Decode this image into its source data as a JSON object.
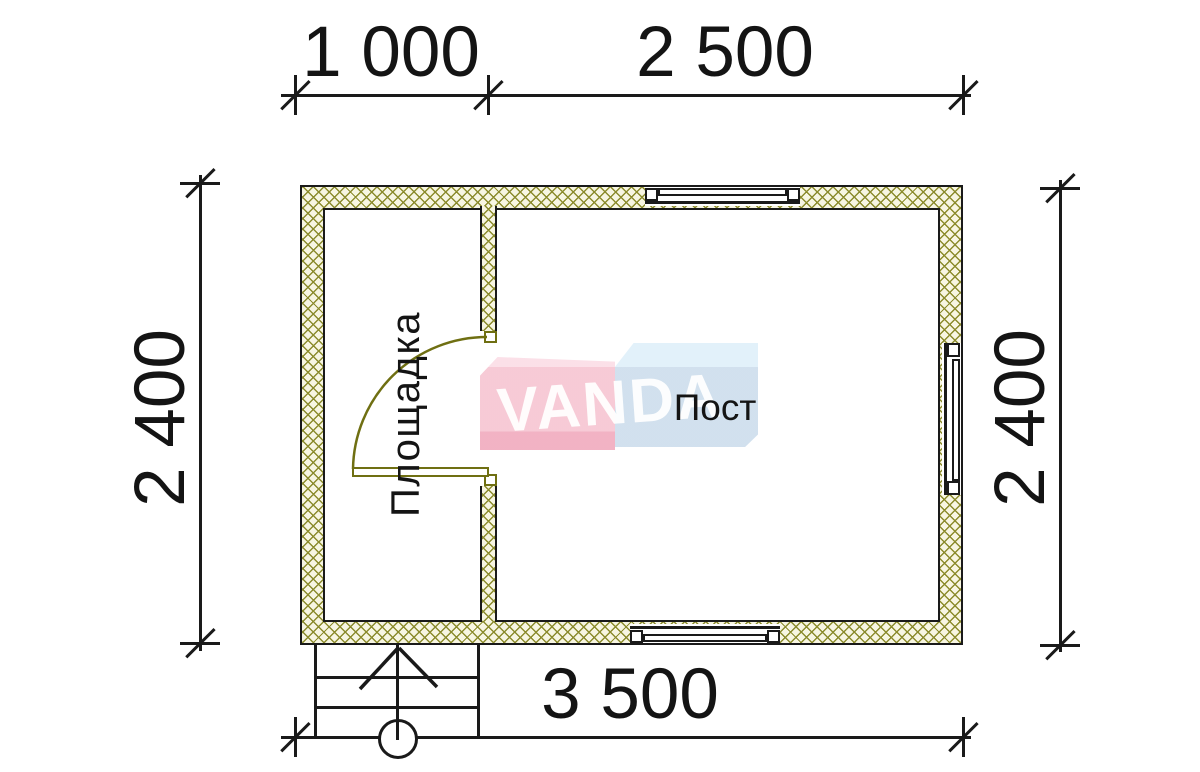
{
  "title": "bathhouse-floor-plan",
  "dimensions": {
    "top": [
      {
        "value": "1 000"
      },
      {
        "value": "2 500"
      }
    ],
    "left": {
      "value": "2 400"
    },
    "right": {
      "value": "2 400"
    },
    "bottom": {
      "value": "3 500"
    }
  },
  "rooms": {
    "left": {
      "label": "Площадка"
    },
    "right": {
      "label": "Пост"
    }
  },
  "watermark": {
    "brand": "VANDA"
  },
  "colors": {
    "line": "#1a1a1a",
    "hatch_line": "#8c8c2d",
    "hatch_bg": "#f8f6e2",
    "door": "#6f6f12",
    "logo_pink": "#f6c6d2",
    "logo_pink_accent": "#f1acbf",
    "logo_blue": "#cfdfed",
    "logo_blue_light": "#e0f0fa"
  }
}
